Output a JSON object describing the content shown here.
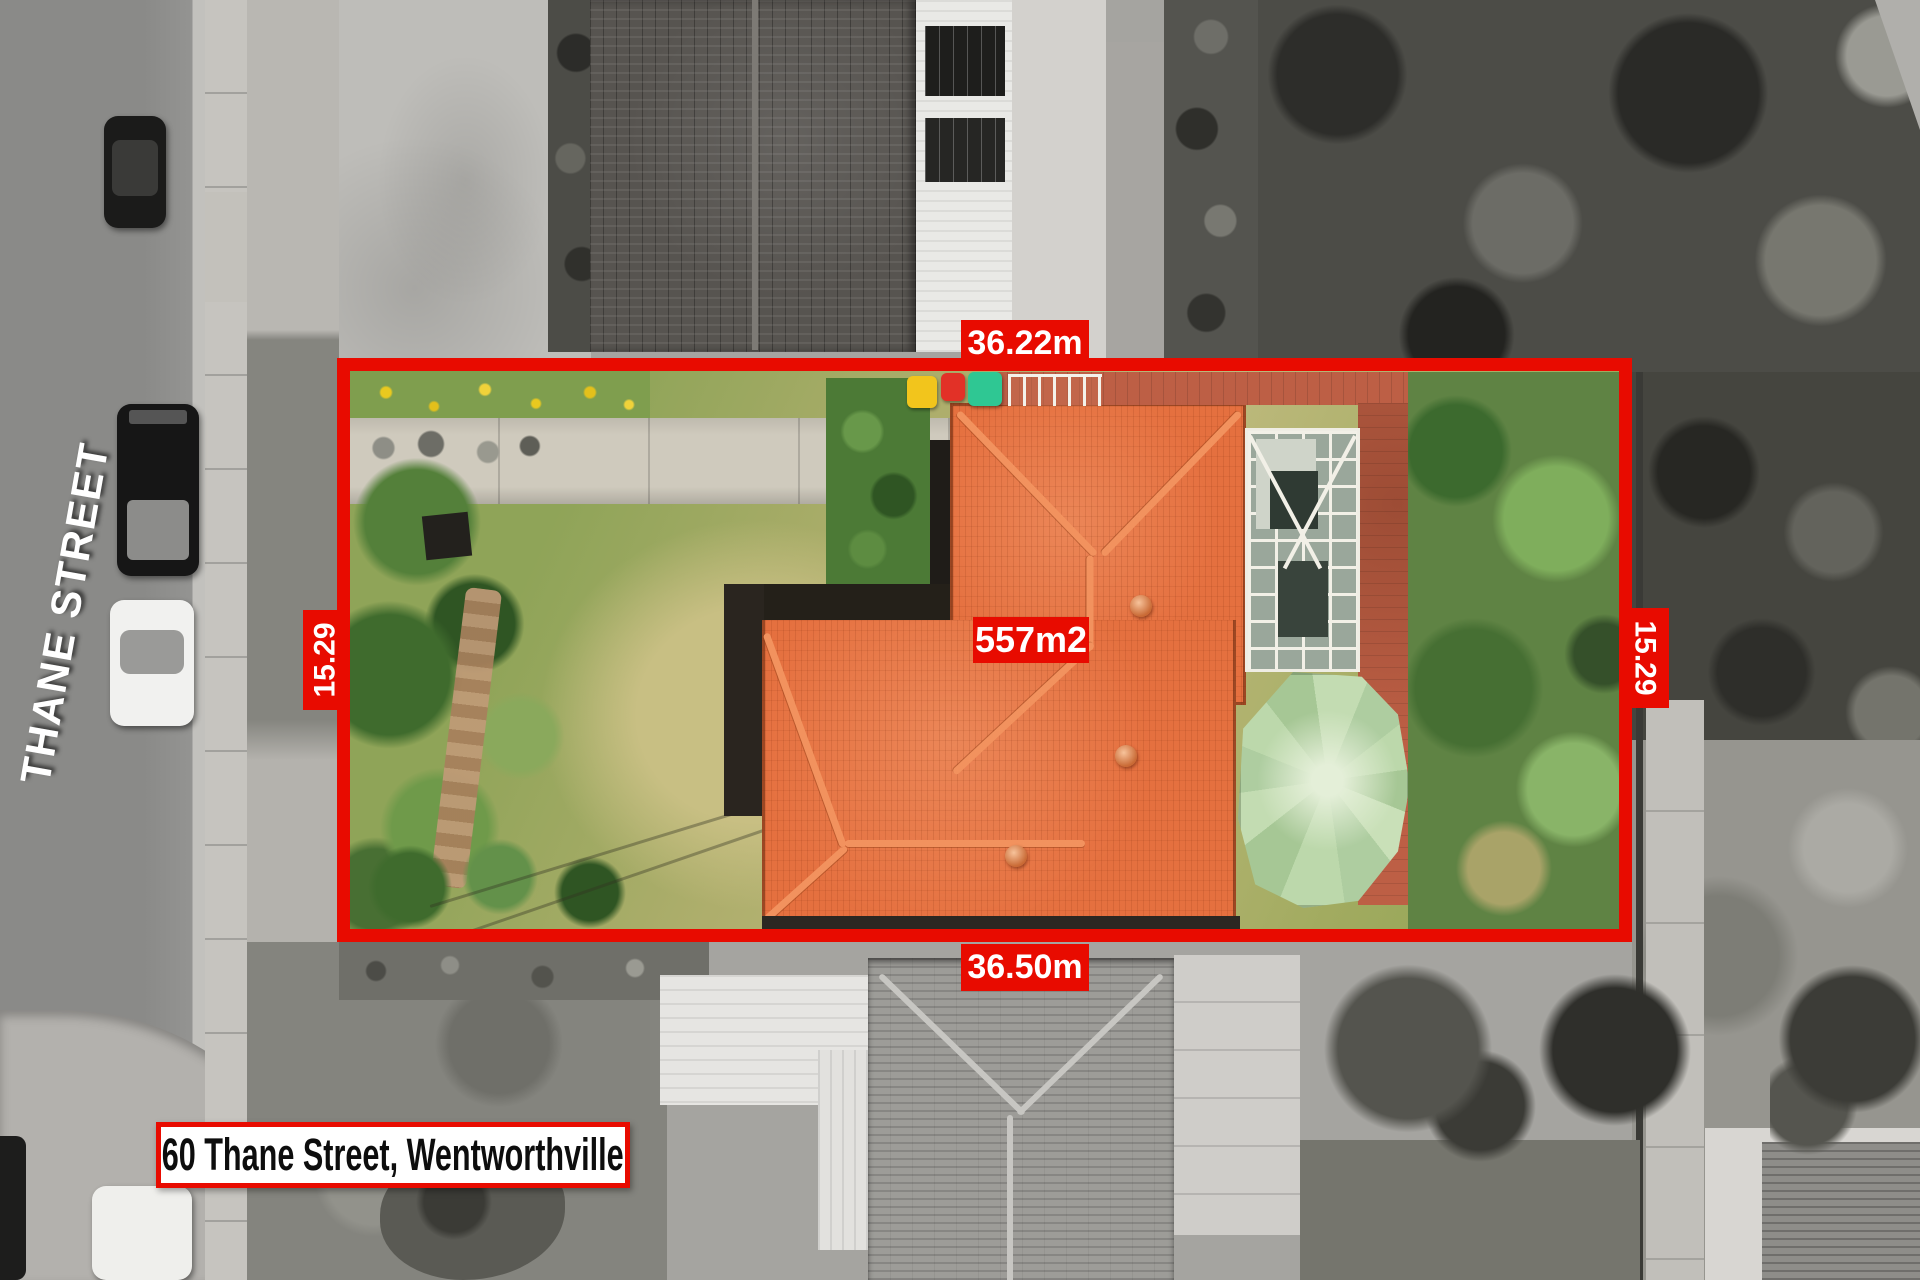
{
  "annotations": {
    "street": "THANE STREET",
    "address": "60 Thane Street, Wentworthville",
    "area": "557m2",
    "width_top": "36.22m",
    "width_bottom": "36.50m",
    "depth_left": "15.29",
    "depth_right": "15.29"
  },
  "colors": {
    "annotation-red": "#e80b00",
    "label-text": "#ffffff",
    "address-text": "#0d0d0d",
    "address-bg": "#ffffff",
    "roof-orange": "#e5703f",
    "gazebo-green": "#bcd8ab",
    "paving-terracotta": "#bd5f45",
    "lawn-green": "#9fae62",
    "hedge-green": "#4c7a36",
    "driveway-concrete": "#cfcabd",
    "road-gray": "#8f8f8d",
    "bin-yellow": "#f2c51c",
    "bin-red": "#e23127",
    "bin-green": "#2fc793"
  },
  "objects": {
    "property": "highlighted colour lot within greyscale aerial photo",
    "vehicles": [
      "dark-car",
      "dark-suv",
      "white-car",
      "white-car-bottom"
    ],
    "bins": [
      "yellow-bin",
      "red-bin",
      "green-bin"
    ]
  }
}
